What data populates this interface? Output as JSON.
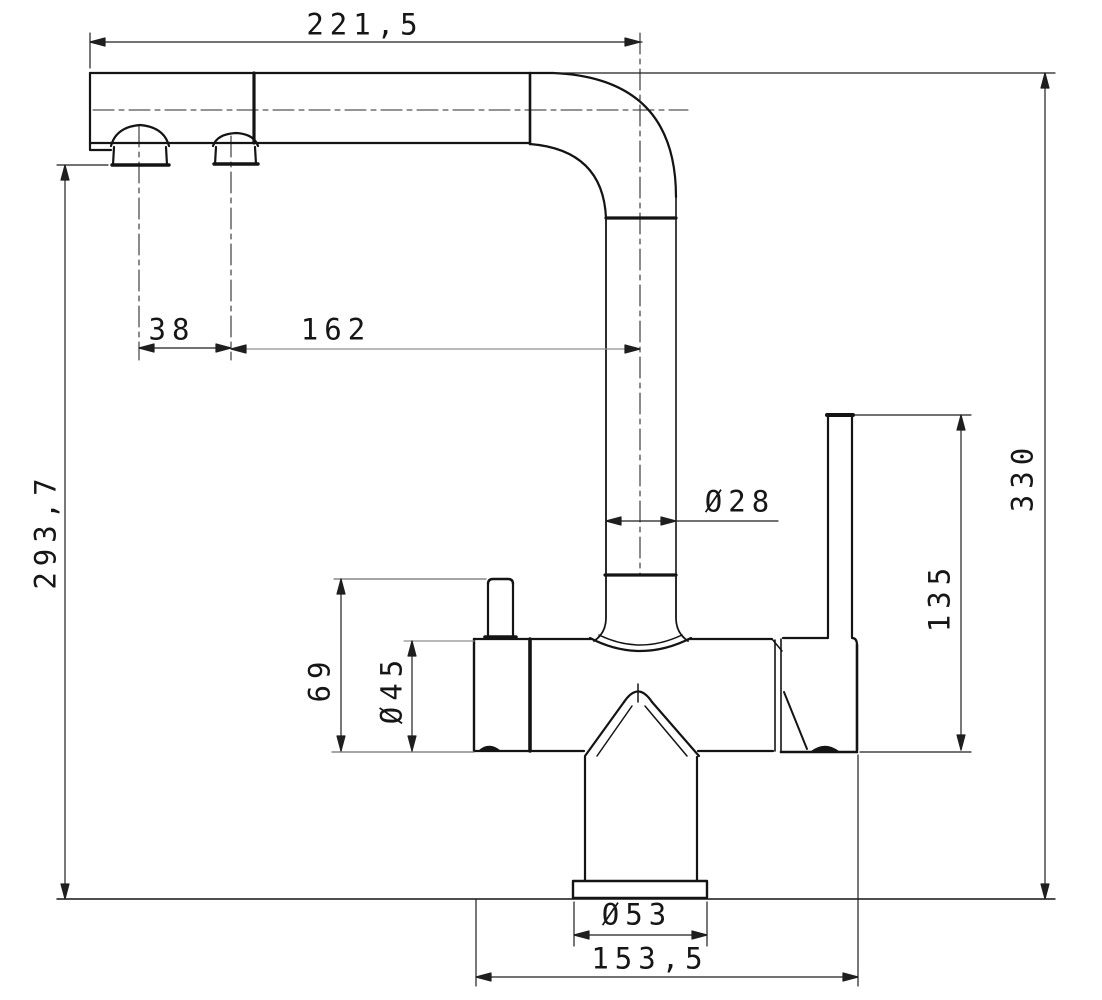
{
  "drawing": {
    "kind": "cad-dimension-drawing",
    "subject": "three-way kitchen mixer tap, side elevation",
    "units": "mm",
    "colors": {
      "object_line": "#141414",
      "dimension_line": "#1f1f1f",
      "thin_aux_line": "#8f8f8f",
      "background": "#ffffff"
    },
    "dimensions": {
      "spout_reach": {
        "value": "221,5",
        "orientation": "horizontal",
        "meaning": "spout projection to riser axis"
      },
      "aerator_spacing": {
        "value": "38",
        "orientation": "horizontal",
        "meaning": "distance between outlet centers"
      },
      "spray_to_riser": {
        "value": "162",
        "orientation": "horizontal",
        "meaning": "second outlet to riser axis"
      },
      "tip_height": {
        "value": "293,7",
        "orientation": "vertical",
        "meaning": "outlet plane above base"
      },
      "overall_height": {
        "value": "330",
        "orientation": "vertical",
        "meaning": "total height above base"
      },
      "spout_diameter": {
        "value": "Ø28",
        "orientation": "horizontal",
        "meaning": "spout tube diameter"
      },
      "lever_height": {
        "value": "135",
        "orientation": "vertical",
        "meaning": "lever top above body bottom"
      },
      "pin_height": {
        "value": "69",
        "orientation": "vertical",
        "meaning": "filter outlet pin top above body bottom"
      },
      "body_diameter": {
        "value": "Ø45",
        "orientation": "vertical",
        "meaning": "body cartridge diameter"
      },
      "base_diameter": {
        "value": "Ø53",
        "orientation": "horizontal",
        "meaning": "base flange diameter"
      },
      "overall_depth": {
        "value": "153,5",
        "orientation": "horizontal",
        "meaning": "body front to lever back"
      }
    }
  }
}
